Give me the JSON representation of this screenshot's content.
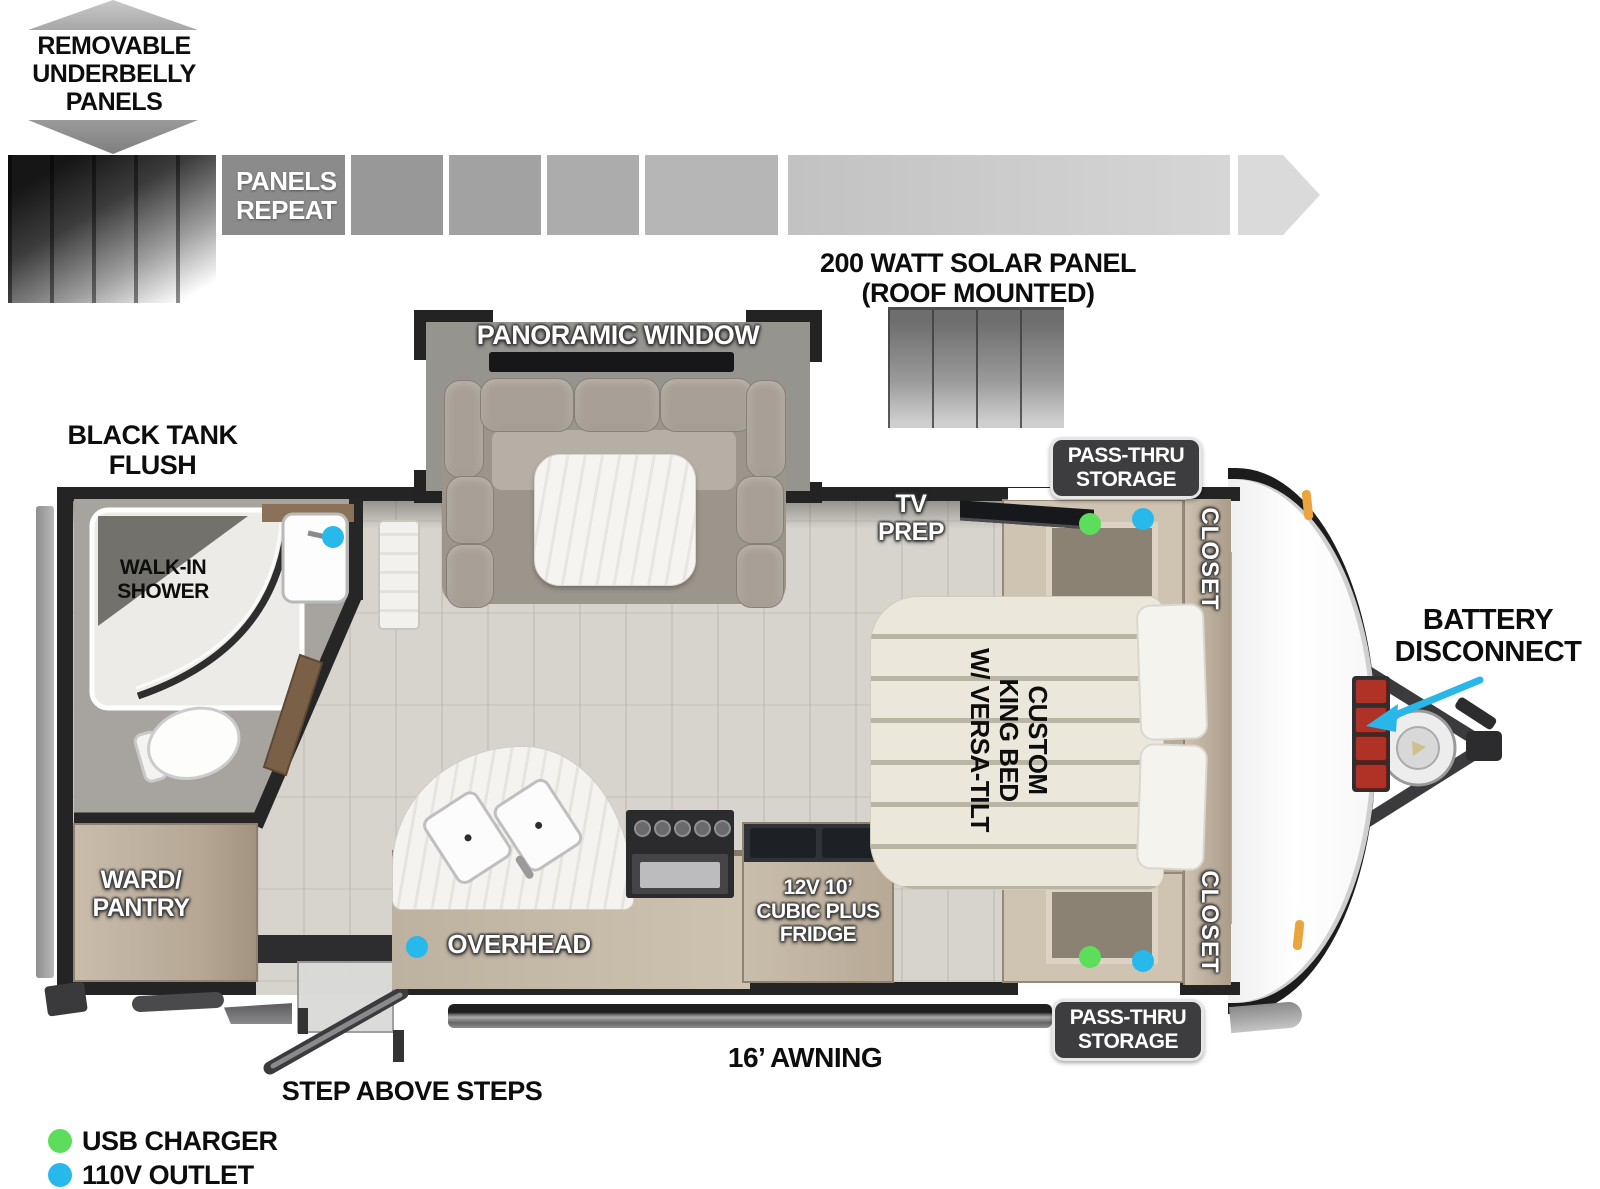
{
  "top": {
    "underbelly_label": "REMOVABLE\nUNDERBELLY\nPANELS",
    "panels_repeat_label": "PANELS\nREPEAT",
    "solar_label": "200 WATT SOLAR PANEL\n(ROOF MOUNTED)"
  },
  "exterior": {
    "black_tank_flush_label": "BLACK TANK\nFLUSH",
    "battery_disconnect_label": "BATTERY\nDISCONNECT",
    "awning_label": "16’ AWNING",
    "step_label": "STEP ABOVE STEPS",
    "pass_thru_top_label": "PASS-THRU\nSTORAGE",
    "pass_thru_bottom_label": "PASS-THRU\nSTORAGE"
  },
  "interior": {
    "panoramic_window_label": "PANORAMIC WINDOW",
    "tv_prep_label": "TV\nPREP",
    "closet_top_label": "CLOSET",
    "closet_bottom_label": "CLOSET",
    "bed_label": "CUSTOM\nKING BED\nW/ VERSA-TILT",
    "walk_in_shower_label": "WALK-IN\nSHOWER",
    "ward_pantry_label": "WARD/\nPANTRY",
    "overhead_label": "OVERHEAD",
    "fridge_label": "12V 10’\nCUBIC PLUS\nFRIDGE"
  },
  "legend": {
    "usb": {
      "label": "USB CHARGER",
      "color": "#5cde5c"
    },
    "outlet": {
      "label": "110V OUTLET",
      "color": "#27b9ec"
    }
  },
  "palette": {
    "wall": "#242424",
    "arrow_cyan": "#29b6e8",
    "battery_red": "#b03226",
    "marker_orange": "#eaa63c"
  }
}
